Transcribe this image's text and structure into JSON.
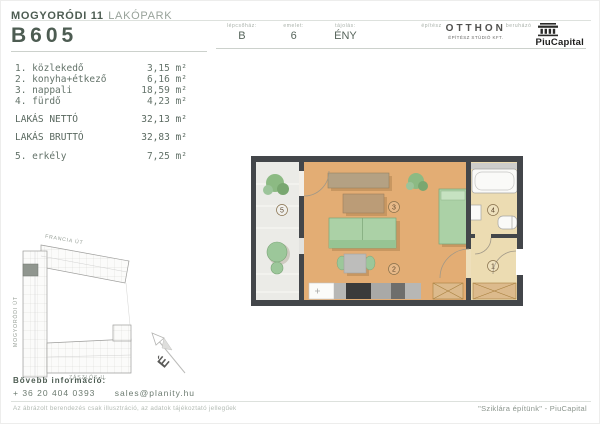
{
  "header": {
    "project_bold": "MOGYORÓDI 11",
    "project_light": "LAKÓPARK",
    "unit_id": "B605",
    "meta": [
      {
        "label": "lépcsőház:",
        "value": "B"
      },
      {
        "label": "emelet:",
        "value": "6"
      },
      {
        "label": "tájolás:",
        "value": "ÉNY"
      }
    ],
    "architect_label": "építész",
    "architect_name": "OTTHON",
    "architect_sub": "ÉPÍTÉSZ STÚDIÓ KFT.",
    "developer_label": "beruházó",
    "developer_name": "PiuCapital"
  },
  "rooms": {
    "list": [
      {
        "label": "1. közlekedő",
        "area": "3,15 m²"
      },
      {
        "label": "2. konyha+étkező",
        "area": "6,16 m²"
      },
      {
        "label": "3. nappali",
        "area": "18,59 m²"
      },
      {
        "label": "4. fürdő",
        "area": "4,23 m²"
      }
    ],
    "net_label": "LAKÁS NETTÓ",
    "net_area": "32,13 m²",
    "gross_label": "LAKÁS BRUTTÓ",
    "gross_area": "32,83 m²",
    "balcony_label": "5. erkély",
    "balcony_area": "7,25 m²"
  },
  "floorplan": {
    "room_labels": {
      "hall": "1",
      "kitchen": "2",
      "living": "3",
      "bath": "4",
      "balcony": "5"
    }
  },
  "siteplan": {
    "street_top": "FRANCIA ÚT",
    "street_left": "MOGYORÓDI ÚT",
    "street_bottom": "ZÁSZLÓS U.",
    "compass_north": "É"
  },
  "footer": {
    "info_label": "Bővebb információ:",
    "phone": "+ 36 20 404 0393",
    "email": "sales@planity.hu",
    "disclaimer": "Az ábrázolt berendezés csak illusztráció, az adatok tájékoztató jellegűek",
    "slogan": "\"Sziklára építünk\" - PiuCapital"
  },
  "colors": {
    "brand_green": "#4d5c52",
    "floor_wood": "#e3ad74",
    "floor_cream": "#ecdcb2",
    "furniture_green": "#abd1a6",
    "wall_dark": "#43464a",
    "highlighted_unit": "#90968f"
  }
}
